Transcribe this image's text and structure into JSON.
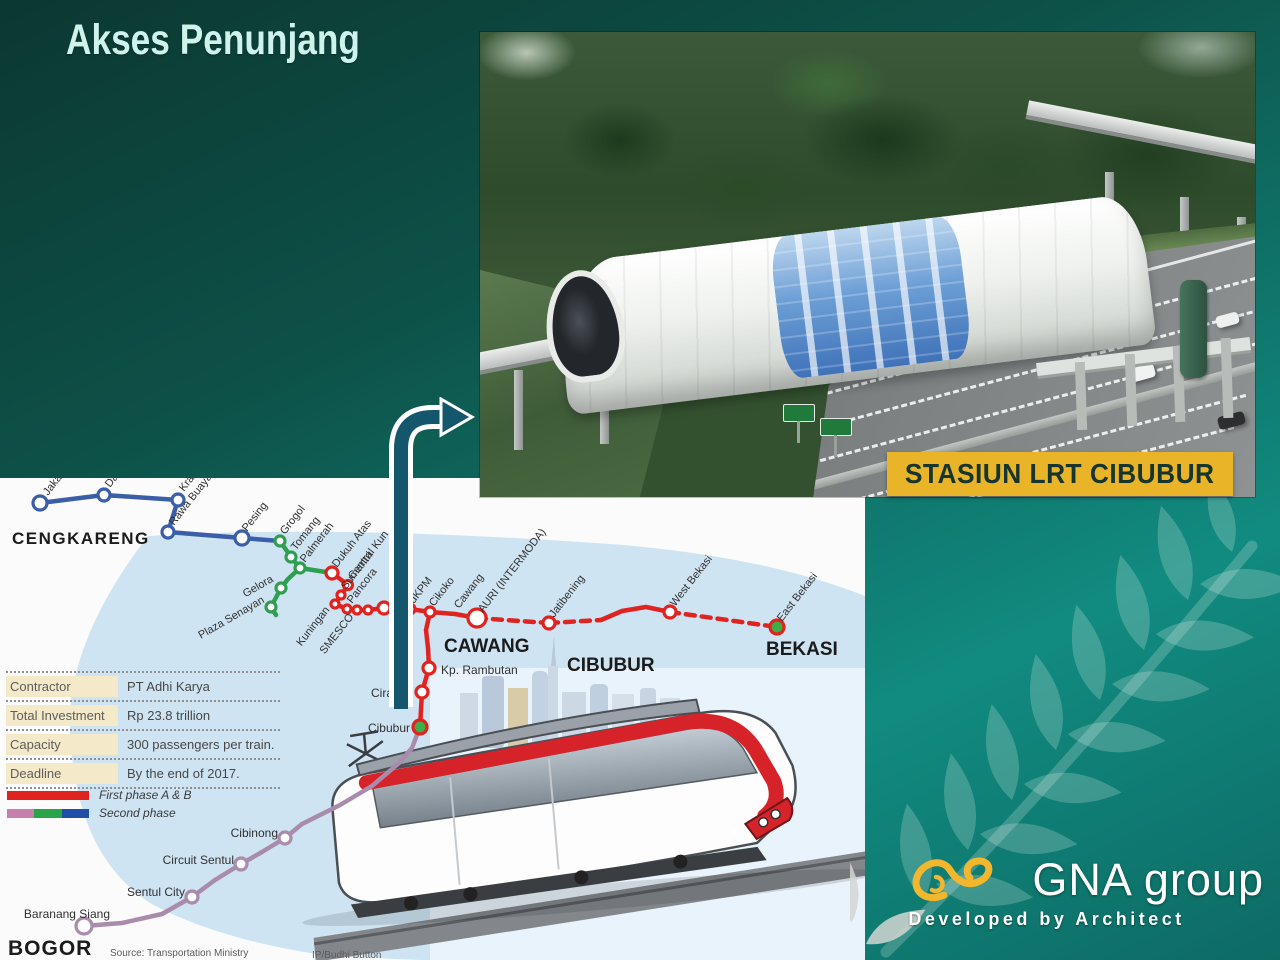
{
  "slide": {
    "title": "Akses Penunjang"
  },
  "photo": {
    "caption": "STASIUN LRT CIBUBUR"
  },
  "logo": {
    "name": "GNA group",
    "tagline": "Developed by Architect",
    "accent": "#f2b72d"
  },
  "colors": {
    "background_top": "#0b3831",
    "background_bottom": "#118b80",
    "banner_yellow": "#e9b428",
    "banner_text": "#16352e",
    "arrow_teal": "#14566b",
    "first_phase_red": "#e1231f",
    "second_phase_blue": "#3b5ea8",
    "second_phase_green": "#2f9e4f",
    "second_phase_pink": "#c77fae",
    "bogor_purple": "#a98bab"
  },
  "info_table": {
    "rows": [
      {
        "label": "Contractor",
        "value": "PT Adhi Karya"
      },
      {
        "label": "Total Investment",
        "value": "Rp 23.8 trillion"
      },
      {
        "label": "Capacity",
        "value": "300 passengers per train."
      },
      {
        "label": "Deadline",
        "value": "By the end of 2017."
      }
    ]
  },
  "legend": {
    "items": [
      {
        "label": "First phase A & B",
        "colors": [
          "#e1231f"
        ]
      },
      {
        "label": "Second phase",
        "colors": [
          "#c77fae",
          "#2aa449",
          "#1f50a8"
        ]
      }
    ]
  },
  "map_notes": {
    "source": "Source: Transportation Ministry",
    "credit": "IP/Budhi Button"
  },
  "route_map": {
    "lines": [
      {
        "id": "second-phase-blue",
        "color": "#3b5ea8",
        "w": 4.5,
        "pts": [
          [
            40,
            25
          ],
          [
            104,
            17
          ],
          [
            178,
            22
          ],
          [
            168,
            54
          ],
          [
            242,
            60
          ],
          [
            280,
            63
          ]
        ]
      },
      {
        "id": "second-phase-green-a",
        "color": "#2f9e4f",
        "w": 4.5,
        "pts": [
          [
            280,
            63
          ],
          [
            291,
            79
          ],
          [
            300,
            90
          ],
          [
            332,
            95
          ]
        ]
      },
      {
        "id": "second-phase-green-b",
        "color": "#2f9e4f",
        "w": 4.5,
        "pts": [
          [
            300,
            90
          ],
          [
            288,
            101
          ],
          [
            281,
            110
          ],
          [
            271,
            129
          ],
          [
            276,
            137
          ]
        ]
      },
      {
        "id": "first-phase-main",
        "color": "#e1231f",
        "w": 4.5,
        "pts": [
          [
            332,
            95
          ],
          [
            348,
            107
          ],
          [
            341,
            117
          ],
          [
            335,
            126
          ],
          [
            347,
            131
          ],
          [
            357,
            132
          ],
          [
            368,
            132
          ],
          [
            384,
            130
          ],
          [
            410,
            131
          ],
          [
            430,
            134
          ],
          [
            455,
            136
          ],
          [
            477,
            140
          ]
        ]
      },
      {
        "id": "first-phase-south",
        "color": "#e1231f",
        "w": 4.5,
        "pts": [
          [
            430,
            134
          ],
          [
            426,
            152
          ],
          [
            428,
            170
          ],
          [
            429,
            190
          ],
          [
            422,
            214
          ],
          [
            420,
            249
          ]
        ]
      },
      {
        "id": "first-phase-dash-a",
        "color": "#e1231f",
        "w": 4.5,
        "dash": "9 7",
        "pts": [
          [
            477,
            140
          ],
          [
            549,
            145
          ]
        ]
      },
      {
        "id": "first-phase-dash-b",
        "color": "#e1231f",
        "w": 4.5,
        "dash": "9 7",
        "pts": [
          [
            549,
            145
          ],
          [
            601,
            142
          ]
        ]
      },
      {
        "id": "first-phase-hump",
        "color": "#e1231f",
        "w": 4.5,
        "pts": [
          [
            601,
            142
          ],
          [
            622,
            133
          ],
          [
            646,
            129
          ],
          [
            670,
            134
          ]
        ]
      },
      {
        "id": "first-phase-dash-c",
        "color": "#e1231f",
        "w": 4.5,
        "dash": "9 7",
        "pts": [
          [
            670,
            134
          ],
          [
            777,
            149
          ]
        ]
      },
      {
        "id": "bogor-extension",
        "color": "#a98bab",
        "w": 4.5,
        "pts": [
          [
            420,
            249
          ],
          [
            412,
            270
          ],
          [
            399,
            285
          ],
          [
            372,
            308
          ],
          [
            340,
            327
          ],
          [
            302,
            346
          ],
          [
            285,
            360
          ],
          [
            262,
            374
          ],
          [
            241,
            386
          ],
          [
            215,
            402
          ],
          [
            192,
            419
          ],
          [
            162,
            436
          ],
          [
            122,
            445
          ],
          [
            84,
            448
          ]
        ]
      }
    ],
    "stations": [
      {
        "x": 40,
        "y": 25,
        "r": 7,
        "c": "#3b5ea8"
      },
      {
        "x": 104,
        "y": 17,
        "r": 6,
        "c": "#3b5ea8"
      },
      {
        "x": 178,
        "y": 22,
        "r": 6,
        "c": "#3b5ea8"
      },
      {
        "x": 168,
        "y": 54,
        "r": 6,
        "c": "#3b5ea8"
      },
      {
        "x": 242,
        "y": 60,
        "r": 7,
        "c": "#3b5ea8"
      },
      {
        "x": 280,
        "y": 63,
        "r": 5,
        "c": "#2f9e4f"
      },
      {
        "x": 291,
        "y": 79,
        "r": 5,
        "c": "#2f9e4f"
      },
      {
        "x": 300,
        "y": 90,
        "r": 5,
        "c": "#2f9e4f"
      },
      {
        "x": 281,
        "y": 110,
        "r": 5,
        "c": "#2f9e4f"
      },
      {
        "x": 271,
        "y": 129,
        "r": 5,
        "c": "#2f9e4f"
      },
      {
        "x": 332,
        "y": 95,
        "r": 6,
        "c": "#e1231f"
      },
      {
        "x": 348,
        "y": 107,
        "r": 4.5,
        "c": "#e1231f"
      },
      {
        "x": 341,
        "y": 117,
        "r": 4,
        "c": "#e1231f"
      },
      {
        "x": 335,
        "y": 126,
        "r": 4,
        "c": "#e1231f"
      },
      {
        "x": 347,
        "y": 131,
        "r": 4,
        "c": "#e1231f"
      },
      {
        "x": 357,
        "y": 132,
        "r": 4,
        "c": "#e1231f"
      },
      {
        "x": 368,
        "y": 132,
        "r": 4,
        "c": "#e1231f"
      },
      {
        "x": 384,
        "y": 130,
        "r": 6,
        "c": "#e1231f"
      },
      {
        "x": 410,
        "y": 131,
        "r": 5,
        "c": "#e1231f"
      },
      {
        "x": 430,
        "y": 134,
        "r": 5,
        "c": "#e1231f"
      },
      {
        "x": 477,
        "y": 140,
        "r": 9,
        "c": "#e1231f"
      },
      {
        "x": 549,
        "y": 145,
        "r": 6,
        "c": "#e1231f"
      },
      {
        "x": 670,
        "y": 134,
        "r": 6,
        "c": "#e1231f"
      },
      {
        "x": 777,
        "y": 149,
        "r": 7,
        "c": "#e1231f",
        "f": "#3fae49"
      },
      {
        "x": 429,
        "y": 190,
        "r": 6,
        "c": "#e1231f"
      },
      {
        "x": 422,
        "y": 214,
        "r": 6,
        "c": "#e1231f"
      },
      {
        "x": 420,
        "y": 249,
        "r": 7,
        "c": "#e1231f",
        "f": "#3fae49"
      },
      {
        "x": 285,
        "y": 360,
        "r": 6,
        "c": "#a98bab"
      },
      {
        "x": 241,
        "y": 386,
        "r": 6,
        "c": "#a98bab"
      },
      {
        "x": 192,
        "y": 419,
        "r": 6,
        "c": "#a98bab"
      },
      {
        "x": 84,
        "y": 448,
        "r": 8,
        "c": "#a98bab"
      }
    ],
    "labels": [
      {
        "t": "Jakar",
        "x": 48,
        "y": 18
      },
      {
        "t": "Da",
        "x": 110,
        "y": 10
      },
      {
        "t": "Kran",
        "x": 184,
        "y": 14
      },
      {
        "t": "Rawa Buaya",
        "x": 174,
        "y": 48
      },
      {
        "t": "Pesing",
        "x": 247,
        "y": 54
      },
      {
        "t": "Grogol",
        "x": 285,
        "y": 57
      },
      {
        "t": "Tomang",
        "x": 296,
        "y": 73
      },
      {
        "t": "Palmerah",
        "x": 305,
        "y": 85
      },
      {
        "t": "Gelora",
        "x": 274,
        "y": 103,
        "a": "end",
        "r": -30
      },
      {
        "t": "Plaza Senayan",
        "x": 265,
        "y": 124,
        "a": "end",
        "r": -30
      },
      {
        "t": "Kuningan",
        "x": 330,
        "y": 132,
        "a": "end"
      },
      {
        "t": "SMESCO",
        "x": 354,
        "y": 139,
        "a": "end"
      },
      {
        "t": "Dukuh Atas",
        "x": 337,
        "y": 90
      },
      {
        "t": "Central Kun",
        "x": 353,
        "y": 102
      },
      {
        "t": "Sumantri",
        "x": 346,
        "y": 112
      },
      {
        "t": "Pancora",
        "x": 352,
        "y": 126
      },
      {
        "t": "dKPM",
        "x": 414,
        "y": 126
      },
      {
        "t": "Cikoko",
        "x": 434,
        "y": 129
      },
      {
        "t": "Cawang",
        "x": 459,
        "y": 131
      },
      {
        "t": "AURI (INTERMODA)",
        "x": 483,
        "y": 135
      },
      {
        "t": "Jatibening",
        "x": 554,
        "y": 140
      },
      {
        "t": "West Bekasi",
        "x": 675,
        "y": 129
      },
      {
        "t": "East Bekasi",
        "x": 782,
        "y": 144
      },
      {
        "t": "Kp. Rambutan",
        "x": 441,
        "y": 196,
        "s": 12,
        "r": 0
      },
      {
        "t": "Ciracas",
        "x": 371,
        "y": 219,
        "s": 12,
        "r": 0
      },
      {
        "t": "Cibubur",
        "x": 410,
        "y": 254,
        "s": 12,
        "r": 0,
        "a": "end"
      },
      {
        "t": "Cibinong",
        "x": 278,
        "y": 359,
        "s": 12,
        "r": 0,
        "a": "end"
      },
      {
        "t": "Circuit Sentul",
        "x": 234,
        "y": 386,
        "s": 12,
        "r": 0,
        "a": "end"
      },
      {
        "t": "Sentul City",
        "x": 185,
        "y": 418,
        "s": 12,
        "r": 0,
        "a": "end"
      },
      {
        "t": "Baranang Siang",
        "x": 110,
        "y": 440,
        "s": 12,
        "r": 0,
        "a": "end"
      },
      {
        "t": "CENGKARENG",
        "x": 12,
        "y": 66,
        "s": 17,
        "w": "bold",
        "r": 0,
        "c": "#1b1b1b",
        "ls": 1.5
      },
      {
        "t": "CAWANG",
        "x": 444,
        "y": 174,
        "s": 19,
        "w": "bold",
        "r": 0,
        "c": "#1b1b1b"
      },
      {
        "t": "CIBUBUR",
        "x": 567,
        "y": 193,
        "s": 19,
        "w": "bold",
        "r": 0,
        "c": "#1b1b1b"
      },
      {
        "t": "BEKASI",
        "x": 766,
        "y": 177,
        "s": 19,
        "w": "bold",
        "r": 0,
        "c": "#1b1b1b"
      },
      {
        "t": "BOGOR",
        "x": 8,
        "y": 477,
        "s": 21,
        "w": "bold",
        "r": 0,
        "c": "#1b1b1b",
        "ls": 1
      },
      {
        "t": "Source: Transportation Ministry",
        "x": 110,
        "y": 478,
        "s": 10,
        "r": 0,
        "c": "#5a5a5a"
      },
      {
        "t": "IP/Budhi Button",
        "x": 312,
        "y": 480,
        "s": 10,
        "r": 0,
        "c": "#5a5a5a"
      }
    ]
  }
}
